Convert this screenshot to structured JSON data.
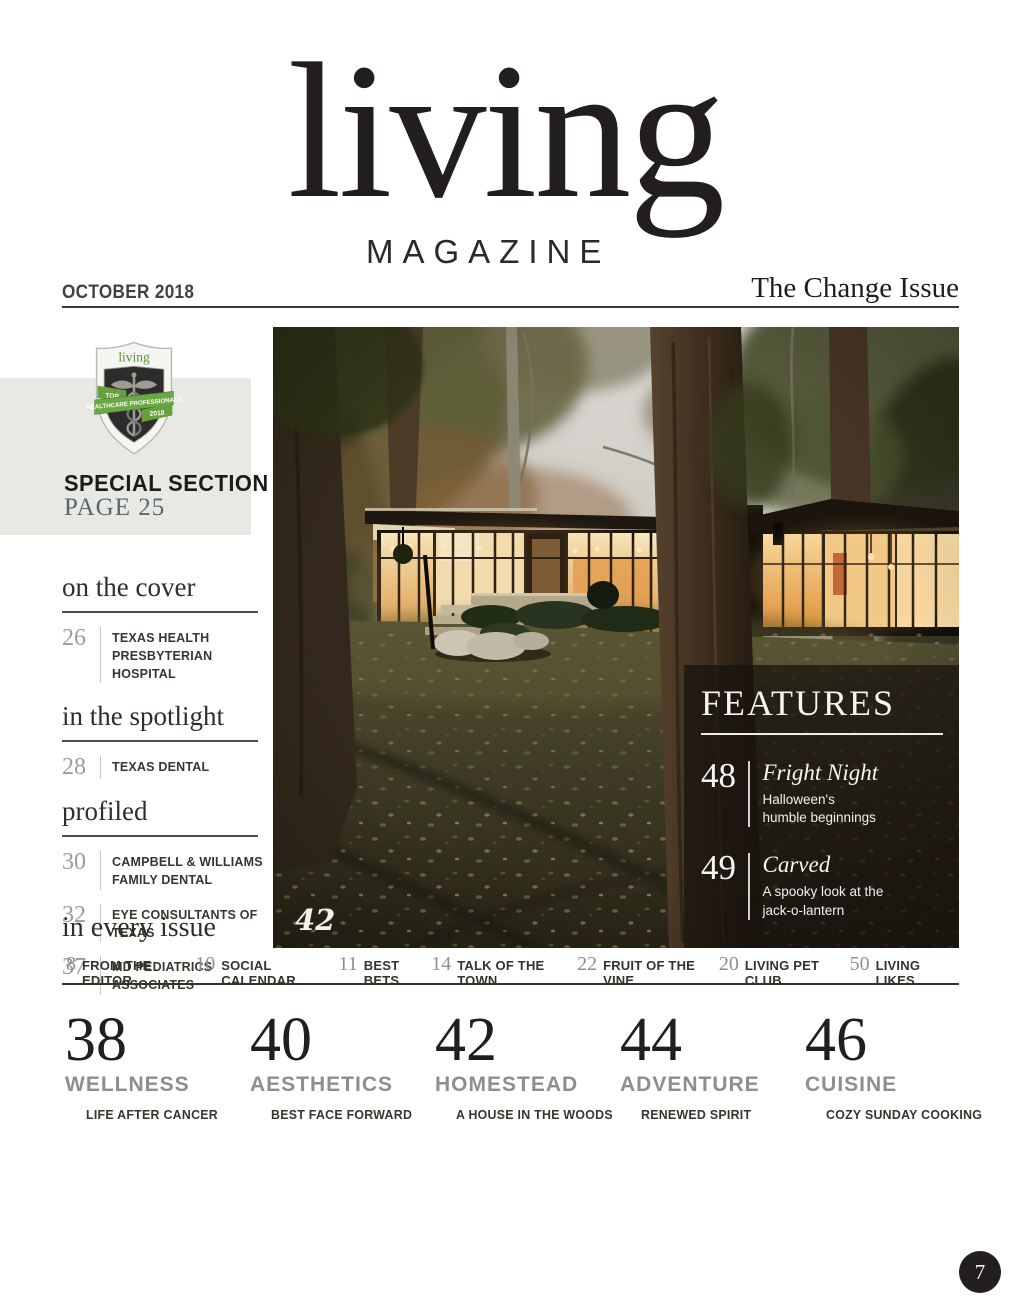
{
  "masthead": {
    "logo_main": "living",
    "logo_sub": "MAGAZINE",
    "issue_date": "OCTOBER 2018",
    "issue_title": "The Change Issue"
  },
  "special_section": {
    "badge": {
      "brand": "living",
      "ribbon_top": "TOP",
      "ribbon_middle": "HEALTHCARE PROFESSIONALS",
      "ribbon_year": "2018",
      "icon": "caduceus-icon"
    },
    "title": "SPECIAL SECTION",
    "page_label": "PAGE 25"
  },
  "sections": [
    {
      "heading": "on the cover",
      "items": [
        {
          "page": "26",
          "title": "TEXAS HEALTH PRESBYTERIAN HOSPITAL"
        }
      ]
    },
    {
      "heading": "in the spotlight",
      "items": [
        {
          "page": "28",
          "title": "TEXAS DENTAL"
        }
      ]
    },
    {
      "heading": "profiled",
      "items": [
        {
          "page": "30",
          "title": "CAMPBELL & WILLIAMS FAMILY DENTAL"
        },
        {
          "page": "32",
          "title": "EYE CONSULTANTS OF TEXAS"
        },
        {
          "page": "37",
          "title": "MD PEDIATRICS ASSOCIATES"
        }
      ]
    }
  ],
  "every_issue": {
    "heading": "in every issue",
    "items": [
      {
        "page": "8",
        "title": "FROM THE EDITOR"
      },
      {
        "page": "10",
        "title": "SOCIAL CALENDAR"
      },
      {
        "page": "11",
        "title": "BEST BETS"
      },
      {
        "page": "14",
        "title": "TALK OF THE TOWN"
      },
      {
        "page": "22",
        "title": "FRUIT OF THE VINE"
      },
      {
        "page": "20",
        "title": "LIVING PET CLUB"
      },
      {
        "page": "50",
        "title": "LIVING LIKES"
      }
    ]
  },
  "features": {
    "heading": "FEATURES",
    "photo_page_label": "42",
    "items": [
      {
        "page": "48",
        "title": "Fright Night",
        "desc_line1": "Halloween's",
        "desc_line2": "humble beginnings"
      },
      {
        "page": "49",
        "title": "Carved",
        "desc_line1": "A spooky look at the",
        "desc_line2": "jack-o-lantern"
      }
    ]
  },
  "departments": [
    {
      "page": "38",
      "category": "WELLNESS",
      "subtitle": "LIFE AFTER CANCER"
    },
    {
      "page": "40",
      "category": "AESTHETICS",
      "subtitle": "BEST FACE FORWARD"
    },
    {
      "page": "42",
      "category": "HOMESTEAD",
      "subtitle": "A HOUSE IN THE WOODS"
    },
    {
      "page": "44",
      "category": "ADVENTURE",
      "subtitle": "RENEWED SPIRIT"
    },
    {
      "page": "46",
      "category": "CUISINE",
      "subtitle": "COZY SUNDAY COOKING"
    }
  ],
  "page_number": "7",
  "colors": {
    "badge_green": "#64a03f",
    "page_label_blue_gray": "#5a676e",
    "panel_overlay": "rgba(22,18,14,0.72)",
    "rule_dark": "#34302a",
    "number_gray": "#9b9b9b",
    "category_gray": "#8e8e8e",
    "window_glow": "#f2b76b"
  }
}
